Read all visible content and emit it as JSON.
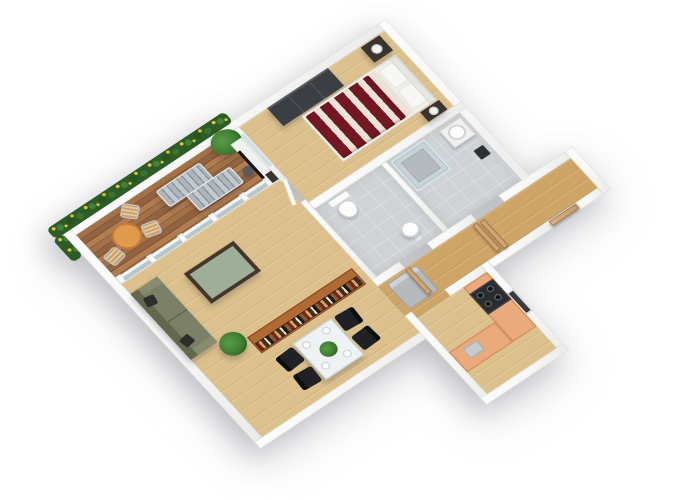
{
  "title": "3D isometric apartment floor plan",
  "background": "#ffffff",
  "palette": {
    "wall": "#f6f6f5",
    "wallEdge": "#dededc",
    "floorWood": "#dcc18c",
    "floorCorridor": "#cfa567",
    "deck": "#96653e",
    "tile": "#cfd3d5",
    "glass": "rgba(180,205,215,0.55)",
    "bedRed": "#731722",
    "bedLinen": "#ece3d8",
    "sofa": "#7c8066",
    "sofaDark": "#63674b",
    "pillowDark": "#2d2e2c",
    "counter": "#eaaa7c",
    "counterEdge": "#d68d5b",
    "stove": "#2b2c30",
    "shelfWood": "#b06a33",
    "doorWood": "#c59a66",
    "doorEdge": "#97683a",
    "chairBlack": "#202124",
    "plantGreen": "#3e7d33",
    "flowerYellow": "#e8c83c",
    "tableGlass": "#eef2f3",
    "darkFurniture": "#3a3430",
    "lampWhite": "#f2f2f2",
    "fridgeGrey": "#b7babc",
    "bistroOrange": "#e09a4e"
  },
  "rooms": [
    {
      "id": "terrace",
      "label": "Terrace with wood decking"
    },
    {
      "id": "living-room",
      "label": "Living room"
    },
    {
      "id": "dining-area",
      "label": "Dining area"
    },
    {
      "id": "bedroom",
      "label": "Bedroom"
    },
    {
      "id": "bathroom",
      "label": "Bathroom with shower"
    },
    {
      "id": "wc",
      "label": "WC with toilet and sink"
    },
    {
      "id": "hallway",
      "label": "Hallway / entry"
    },
    {
      "id": "kitchen",
      "label": "Kitchen"
    }
  ],
  "furniture": [
    "flower planters",
    "sun loungers",
    "bistro table with chairs",
    "tall potted plant",
    "olive sofa with pillows",
    "glass coffee table",
    "potted plant",
    "tv media unit",
    "bookshelf with books",
    "glass dining table",
    "black dining chairs",
    "plates",
    "plant centerpiece",
    "double bed with red striped duvet",
    "nightstands with lamps",
    "wardrobe",
    "glass shower",
    "washbasins",
    "toilet",
    "open wooden doors",
    "kitchen counters",
    "stove with burners",
    "fridge cabinet"
  ]
}
